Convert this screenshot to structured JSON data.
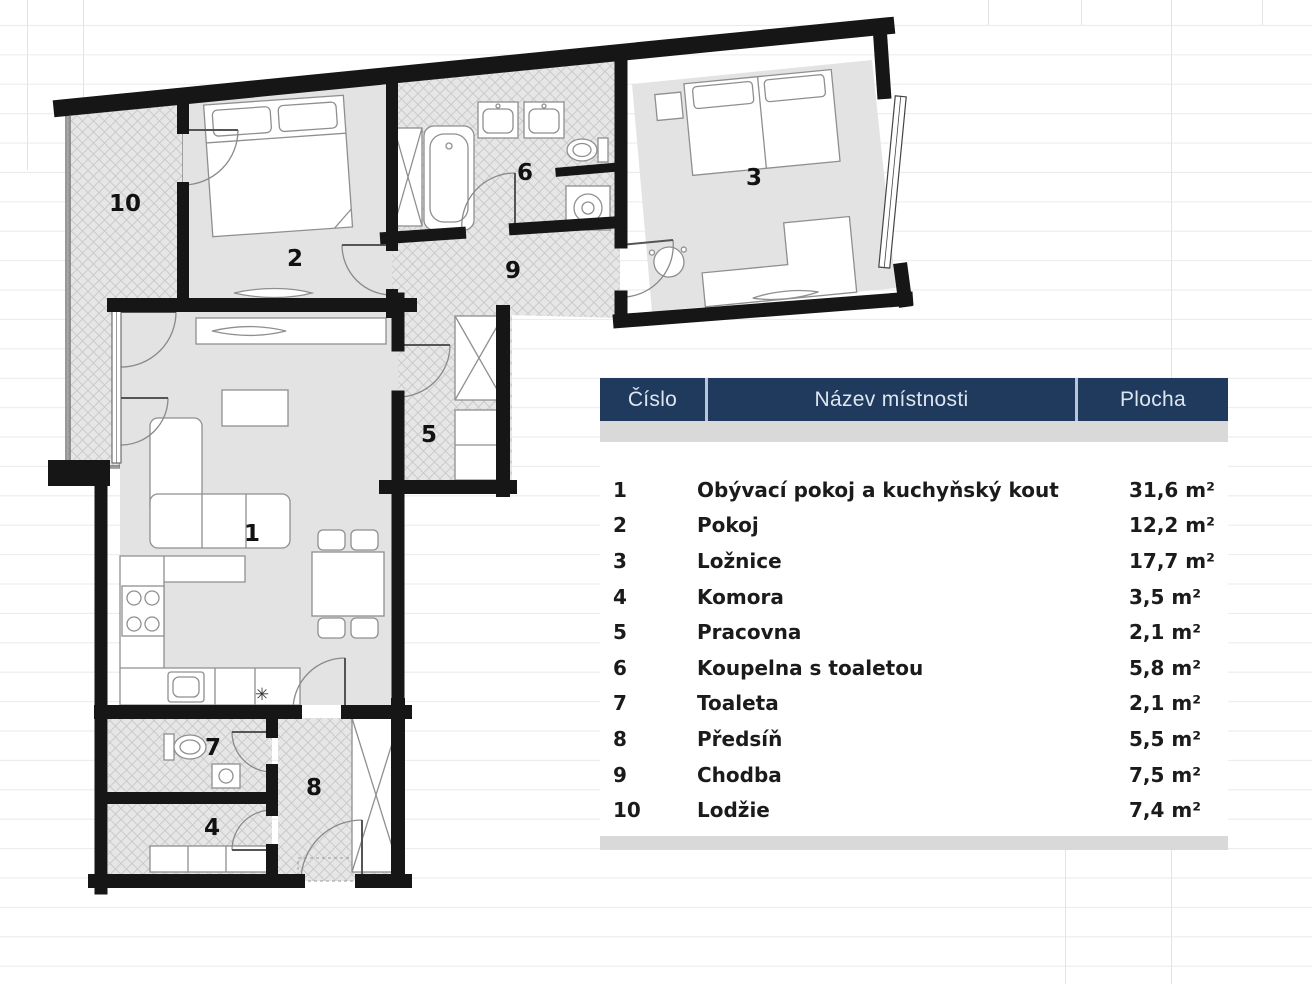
{
  "floor_plan": {
    "labels": [
      {
        "number": "1"
      },
      {
        "number": "2"
      },
      {
        "number": "3"
      },
      {
        "number": "4"
      },
      {
        "number": "5"
      },
      {
        "number": "6"
      },
      {
        "number": "7"
      },
      {
        "number": "8"
      },
      {
        "number": "9"
      },
      {
        "number": "10"
      }
    ],
    "kitchen_symbol": "✳"
  },
  "table": {
    "headers": {
      "number": "Číslo",
      "name": "Název místnosti",
      "area": "Plocha"
    },
    "rows": [
      {
        "number": "1",
        "name": "Obývací pokoj a kuchyňský kout",
        "area": "31,6 m²"
      },
      {
        "number": "2",
        "name": "Pokoj",
        "area": "12,2 m²"
      },
      {
        "number": "3",
        "name": "Ložnice",
        "area": "17,7 m²"
      },
      {
        "number": "4",
        "name": "Komora",
        "area": "3,5 m²"
      },
      {
        "number": "5",
        "name": "Pracovna",
        "area": "2,1 m²"
      },
      {
        "number": "6",
        "name": "Koupelna s toaletou",
        "area": "5,8 m²"
      },
      {
        "number": "7",
        "name": "Toaleta",
        "area": "2,1 m²"
      },
      {
        "number": "8",
        "name": "Předsíň",
        "area": "5,5 m²"
      },
      {
        "number": "9",
        "name": "Chodba",
        "area": "7,5 m²"
      },
      {
        "number": "10",
        "name": "Lodžie",
        "area": "7,4 m²"
      }
    ],
    "colors": {
      "header_bg": "#1f3a5c",
      "header_text": "#dde6f0",
      "band": "#d9d9d9",
      "row_text": "#1b1b1b"
    }
  }
}
